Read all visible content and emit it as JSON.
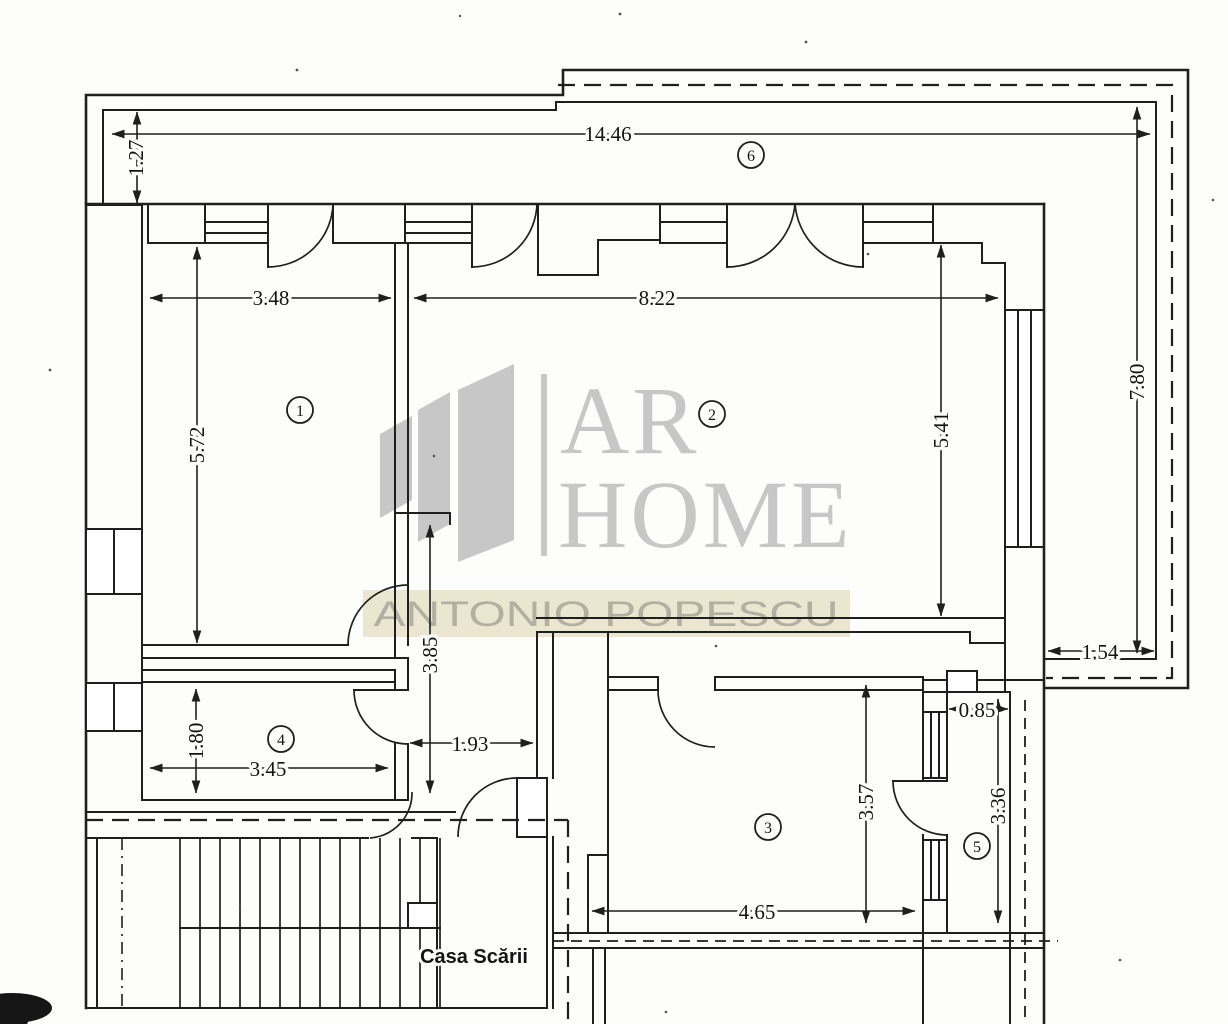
{
  "watermark": {
    "brand_top": "AR",
    "brand_bottom": "HOME",
    "agent": "ANTONIO POPESCU",
    "band_color": "#ebe6d0",
    "logo_color": "#c7c7c7"
  },
  "plan": {
    "stairwell_label": "Casa Scării",
    "rooms": [
      {
        "number": "1"
      },
      {
        "number": "2"
      },
      {
        "number": "3"
      },
      {
        "number": "4"
      },
      {
        "number": "5"
      },
      {
        "number": "6"
      }
    ],
    "dims": {
      "top_width": "14.46",
      "balcony_depth": "1.27",
      "room1_width": "3.48",
      "room2_width": "8.22",
      "room1_height": "5.72",
      "room2_height": "5.41",
      "right_height": "7.80",
      "hall_length": "3.85",
      "room4_height": "1.80",
      "room4_width": "3.45",
      "hall_width": "1.93",
      "balcony_right_width": "1.54",
      "room5_width": "0.85",
      "room3_height": "3.57",
      "room5_height": "3.36",
      "room3_width": "4.65"
    }
  }
}
